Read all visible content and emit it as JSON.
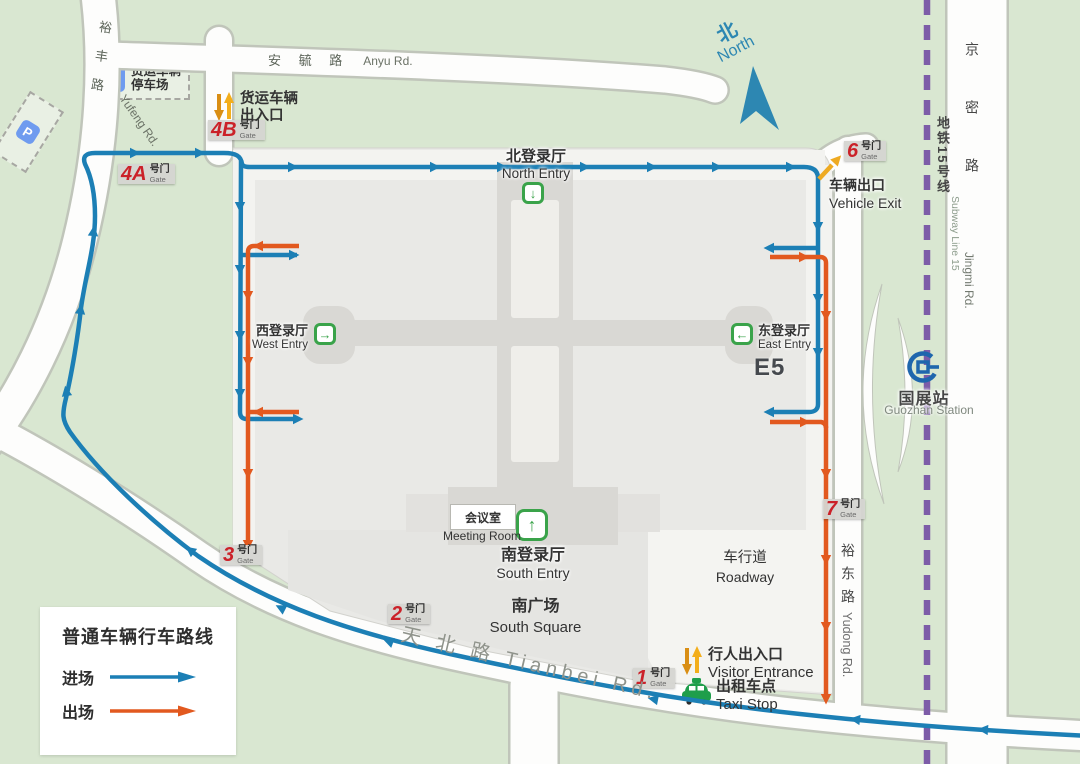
{
  "legend": {
    "title": "普通车辆行车路线",
    "entry": "进场",
    "exit": "出场",
    "entry_color": "#1c7fb5",
    "exit_color": "#e2591f"
  },
  "compass": {
    "zh": "北",
    "en": "North"
  },
  "roads": {
    "yufeng_zh": "裕丰路",
    "yufeng_en": "Yufeng Rd.",
    "anyu_zh": "安 毓 路",
    "anyu_en": "Anyu Rd.",
    "tianbei": "天 北 路  Tianbei Rd.",
    "yudong_zh": "裕东路",
    "yudong_en": "Yudong Rd.",
    "jingmi_zh": "京密路",
    "jingmi_en": "Jingmi Rd."
  },
  "subway": {
    "line_zh": "地铁15号线",
    "line_en": "Subway Line 15",
    "station_zh": "国展站",
    "station_en": "Guozhan Station"
  },
  "gates": {
    "suffix": "号门",
    "sub": "Gate",
    "list": [
      "4B",
      "4A",
      "3",
      "2",
      "1",
      "6",
      "7"
    ]
  },
  "entries": {
    "north_zh": "北登录厅",
    "north_en": "North Entry",
    "west_zh": "西登录厅",
    "west_en": "West Entry",
    "east_zh": "东登录厅",
    "east_en": "East Entry",
    "south_zh": "南登录厅",
    "south_en": "South Entry"
  },
  "halls": [
    {
      "code": "W4",
      "line1": "综合主题馆",
      "line2": ""
    },
    {
      "code": "W3",
      "line1": "煤矿机电",
      "line2": "生产辅助系统"
    },
    {
      "code": "W2",
      "line1": "煤矿机电",
      "line2": "生产辅助系统"
    },
    {
      "code": "W1",
      "line1": "国际馆",
      "line2": ""
    },
    {
      "code": "E4",
      "line1": "综合主题馆",
      "line2": ""
    },
    {
      "code": "E3",
      "line1": "掘进",
      "line2": "辅助运输"
    },
    {
      "code": "E2",
      "line1": "井下开采",
      "line2": "成套装备"
    },
    {
      "code": "E1",
      "line1": "井下开采",
      "line2": "成套装备"
    },
    {
      "code": "E5",
      "line1": "综合主题馆",
      "line2": ""
    }
  ],
  "labels": {
    "unloading": "卸货区",
    "p": "P",
    "p5": "P5",
    "vip": "VIP",
    "freight_park1": "货运车辆",
    "freight_park2": "停车场",
    "freight_gate1": "货运车辆",
    "freight_gate2": "出入口",
    "vehicle_exit_zh": "车辆出口",
    "vehicle_exit_en": "Vehicle Exit",
    "visitor_zh": "行人出入口",
    "visitor_en": "Visitor Entrance",
    "taxi_zh": "出租车点",
    "taxi_en": "Taxi Stop",
    "roadway_zh": "车行道",
    "roadway_en": "Roadway",
    "south_square_zh": "南广场",
    "south_square_en": "South Square",
    "meeting_zh": "会议室",
    "meeting_en": "Meeting Room"
  }
}
